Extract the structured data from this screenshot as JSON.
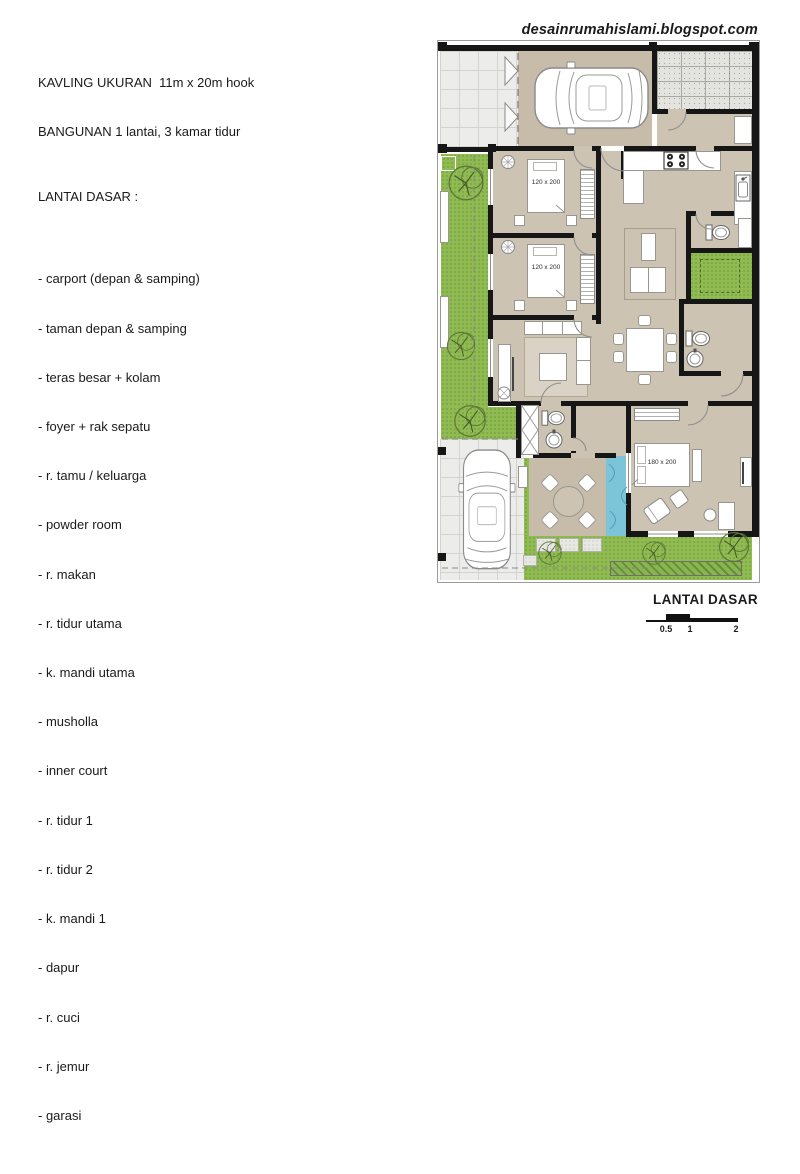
{
  "header": {
    "site_url": "desainrumahislami.blogspot.com"
  },
  "left_panel": {
    "line1": "KAVLING UKURAN  11m x 20m hook",
    "line2": "BANGUNAN 1 lantai, 3 kamar tidur",
    "section_title": "LANTAI DASAR :",
    "items": [
      "- carport (depan & samping)",
      "- taman depan & samping",
      "- teras besar + kolam",
      "- foyer + rak sepatu",
      "- r. tamu / keluarga",
      "- powder room",
      "- r. makan",
      "- r. tidur utama",
      "- k. mandi utama",
      "- musholla",
      "- inner court",
      "- r. tidur 1",
      "- r. tidur 2",
      "- k. mandi 1",
      "- dapur",
      "- r. cuci",
      "- r. jemur",
      "- garasi"
    ]
  },
  "plan": {
    "caption": "LANTAI DASAR",
    "bed_label_small": "120 x 200",
    "bed_label_master": "180 x 200",
    "scale_labels": [
      "0.5",
      "1",
      "2"
    ],
    "colors": {
      "floor_interior": "#cdc3b2",
      "floor_outdoor": "#c7bcaa",
      "garden_green": "#8fbb52",
      "pool_blue": "#7cc5d8",
      "wall_black": "#161616",
      "carport_tile": "#ececea",
      "stone_tile": "#e3e3df"
    },
    "icons": {
      "car": "top-view-car-icon",
      "tree": "plan-tree-icon",
      "toilet": "toilet-icon",
      "round_sink": "round-sink-icon",
      "kitchen_sink": "kitchen-sink-icon",
      "stove": "stove-4-burner-icon",
      "dining_set": "dining-table-icon",
      "terrace_set": "round-table-icon"
    }
  }
}
